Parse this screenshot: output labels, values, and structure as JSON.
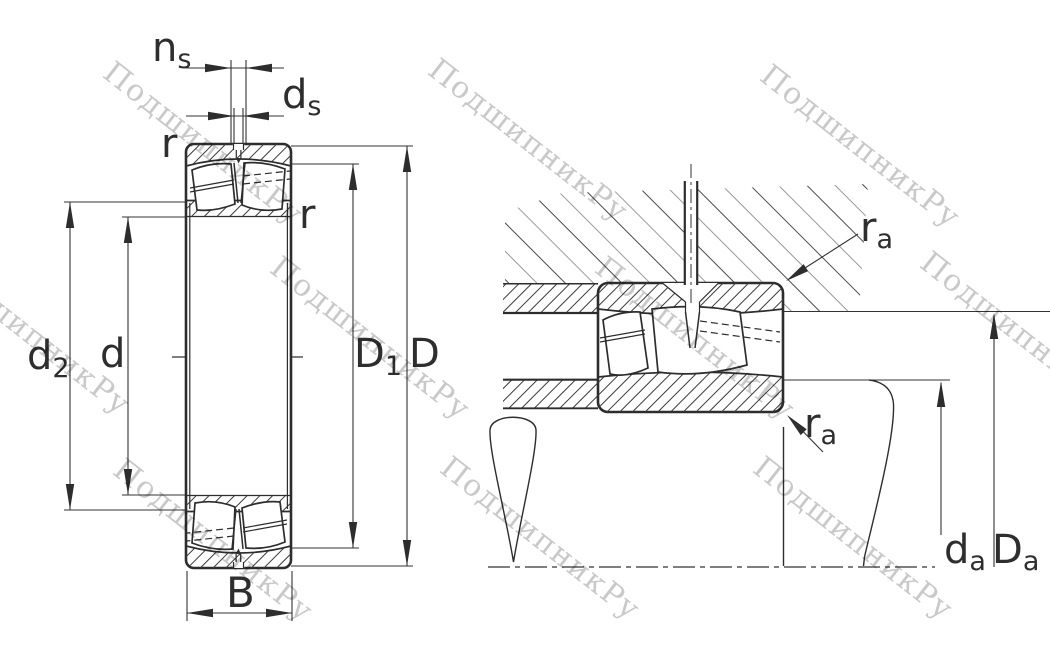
{
  "figure": {
    "type": "spherical-roller-bearing-technical-drawing",
    "views": [
      "front-section-view",
      "mounting-section-view"
    ],
    "line_color": "#2d2d2d"
  },
  "labels": {
    "ns_main": "n",
    "ns_sub": "s",
    "ds_main": "d",
    "ds_sub": "s",
    "r_top": "r",
    "r_right": "r",
    "d2_main": "d",
    "d2_sub": "2",
    "d": "d",
    "D1_main": "D",
    "D1_sub": "1",
    "D": "D",
    "B": "B",
    "ra_top_main": "r",
    "ra_top_sub": "a",
    "ra_bottom_main": "r",
    "ra_bottom_sub": "a",
    "da_main": "d",
    "da_sub": "a",
    "Da_main": "D",
    "Da_sub": "a"
  },
  "watermark": {
    "text": "ПодшипникРу",
    "color": "#c9c9c9"
  }
}
